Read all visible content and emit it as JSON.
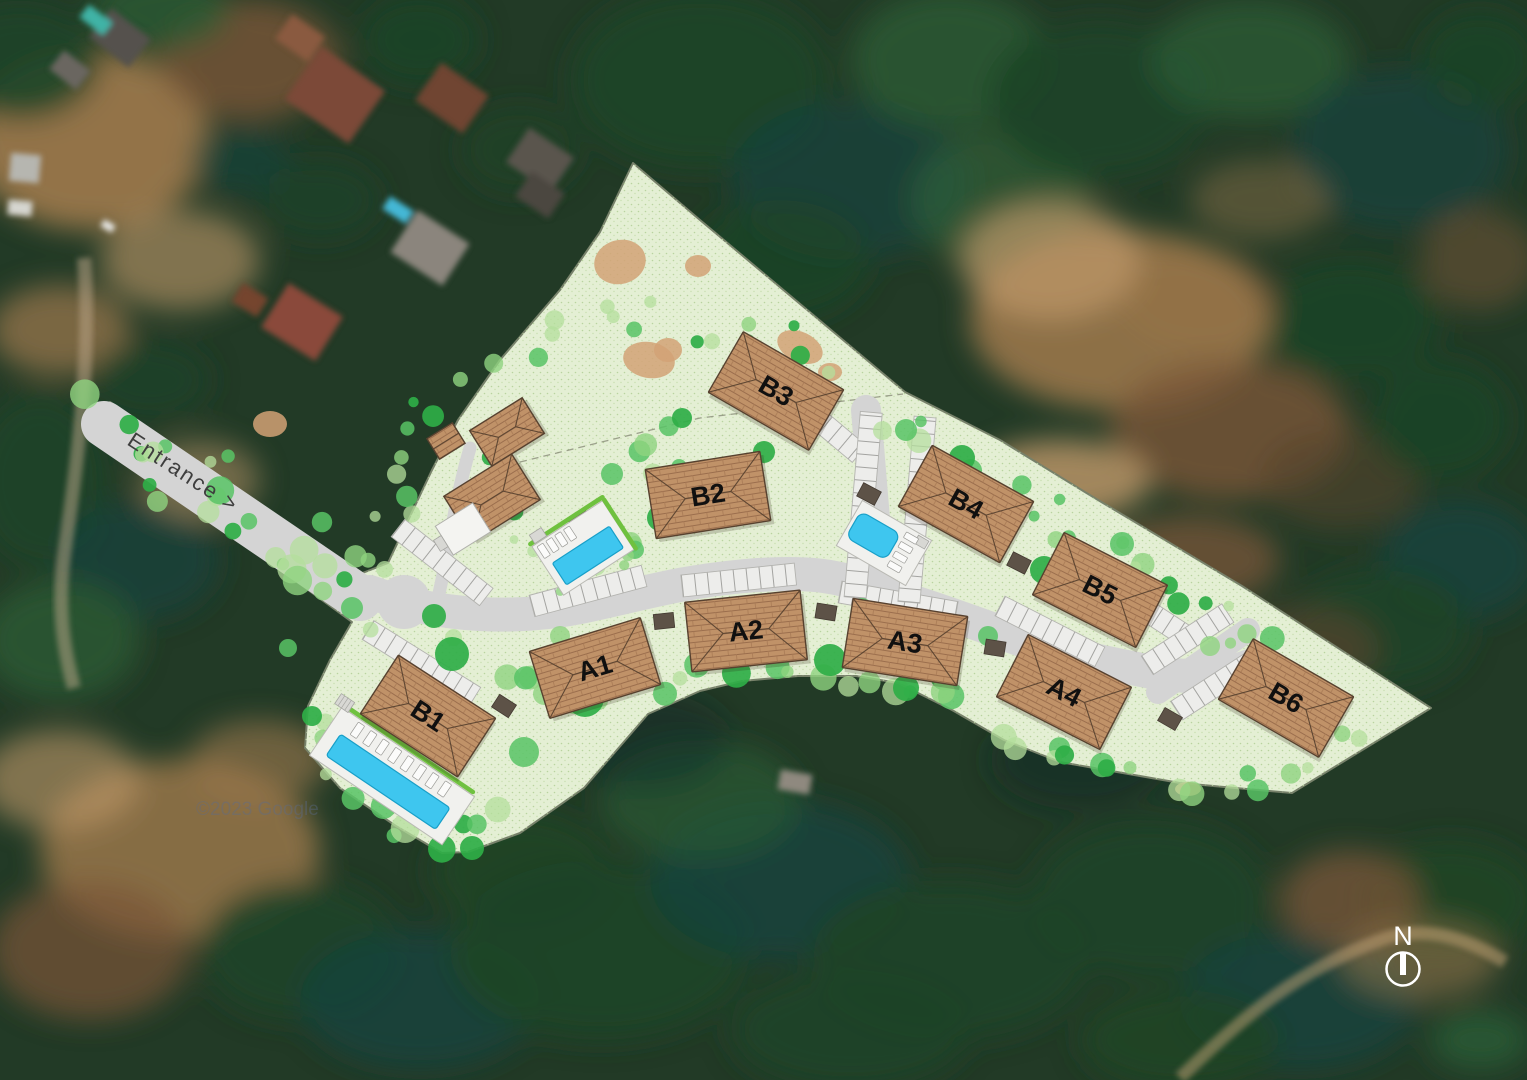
{
  "map": {
    "entrance_label": "Entrance >",
    "north_label": "N",
    "watermark": "©2023 Google",
    "buildings": [
      {
        "id": "B1",
        "label": "B1"
      },
      {
        "id": "A1",
        "label": "A1"
      },
      {
        "id": "A2",
        "label": "A2"
      },
      {
        "id": "A3",
        "label": "A3"
      },
      {
        "id": "A4",
        "label": "A4"
      },
      {
        "id": "B2",
        "label": "B2"
      },
      {
        "id": "B3",
        "label": "B3"
      },
      {
        "id": "B4",
        "label": "B4"
      },
      {
        "id": "B5",
        "label": "B5"
      },
      {
        "id": "B6",
        "label": "B6"
      }
    ],
    "colors": {
      "site_fill": "#e4efd4",
      "site_boundary": "#77816a",
      "road": "#d4d4d4",
      "parking_stall": "#ededeb",
      "roof_tile": "#c09268",
      "roof_line": "#9b6e4d",
      "roof_edge": "#57412f",
      "pool_water": "#3ec6ef",
      "pool_deck": "#f1f1ee",
      "tree_bright": "#2fae47",
      "tree_medium": "#58c365",
      "tree_light": "#8fd37f",
      "tree_pale": "#b4df9c",
      "dirt_patch": "#d2a276",
      "utility_pad": "#5d5247",
      "building_label": "#101010",
      "entrance_label": "#3e3e3e",
      "north_symbol": "#ffffff",
      "watermark": "#5b6d91"
    }
  }
}
